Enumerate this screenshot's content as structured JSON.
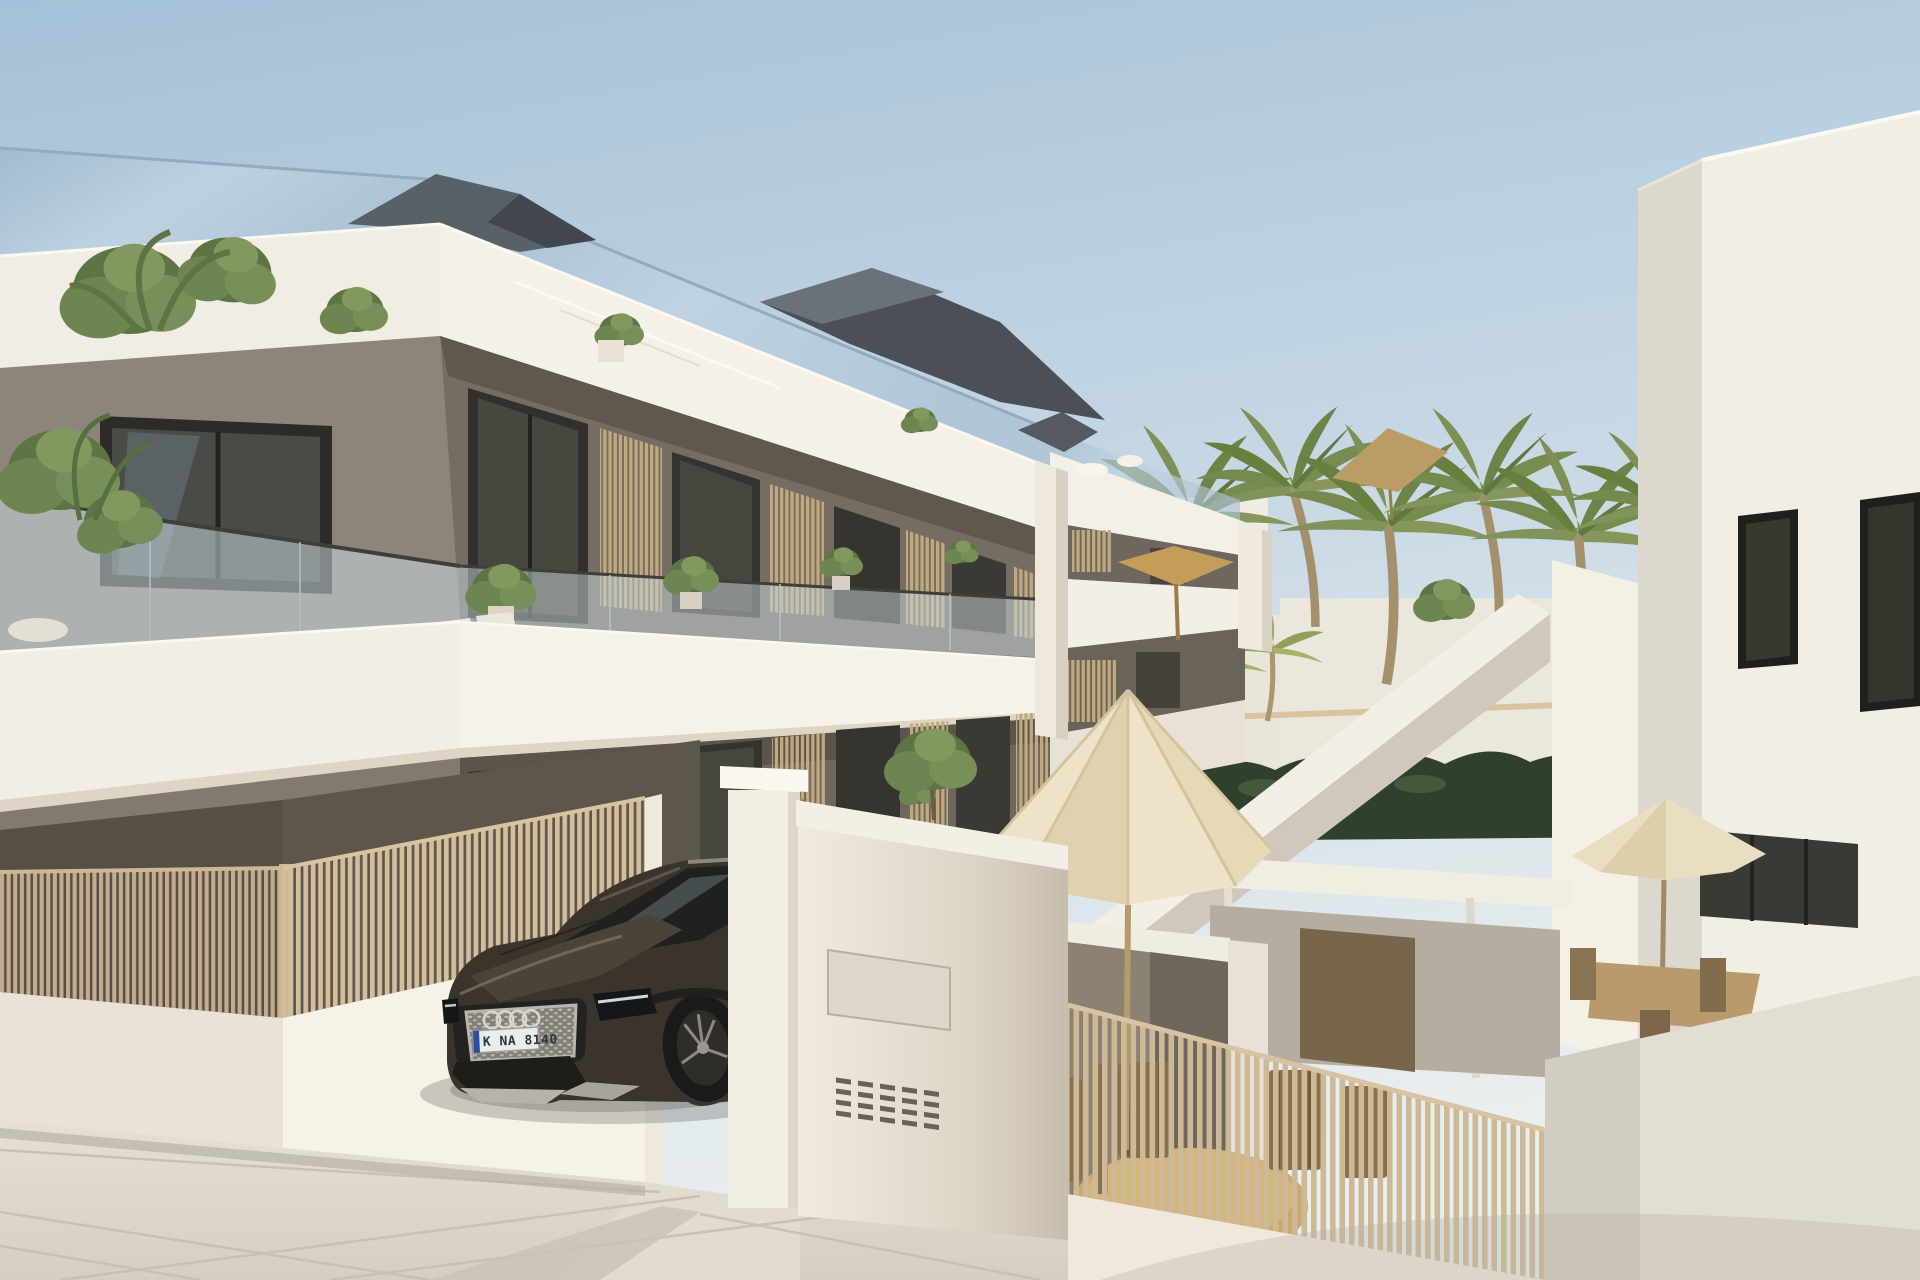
{
  "image": {
    "kind": "photoreal 3D architectural exterior render",
    "subject": "modern three-storey apartment building with roof terraces, pool courtyard, palm trees and a dark SUV at the entrance gate",
    "width": 1920,
    "height": 1280
  },
  "car": {
    "make_hint": "audi-suv",
    "license_plate": {
      "text": "K NA 8140",
      "eu_strip_color": "#2b4ea0",
      "plate_color": "#e9edec"
    }
  },
  "palette": {
    "sky_top": "#a8c3d8",
    "sky_mid": "#c6d7e4",
    "sky_low": "#e4ebec",
    "band_white": "#f5f0e7",
    "band_shade": "#d8cfc0",
    "facade_dark": "#6e675d",
    "facade_deep": "#57524b",
    "wood_slat": "#c9b394",
    "wood_slat_lit": "#d2bc9b",
    "glass_dark": "#3f3e3a",
    "balustrade_glass": "#c8d6da",
    "hedge_green": "#31402c",
    "palm_green": "#76894f",
    "umbrella_cream": "#eadec2",
    "parasol_tan": "#c49e58",
    "paving": "#dcd6ca",
    "car_body": "#3a342c",
    "roof_mass": "#4a5056"
  },
  "elements": [
    "sky",
    "main-building",
    "recessed-building-block",
    "roof-terrace-glass",
    "roof-masses",
    "balcony-glass",
    "wood-partitions",
    "balcony-plants",
    "street-fence",
    "base-wall",
    "entrance-gate",
    "mailbox-wall",
    "suv-car",
    "palm-trees",
    "hedge",
    "pergola",
    "pool-courtyard",
    "patio-umbrella",
    "far-umbrella",
    "dining-set",
    "outdoor-sofa",
    "staircase-parapet",
    "right-building",
    "paving"
  ]
}
